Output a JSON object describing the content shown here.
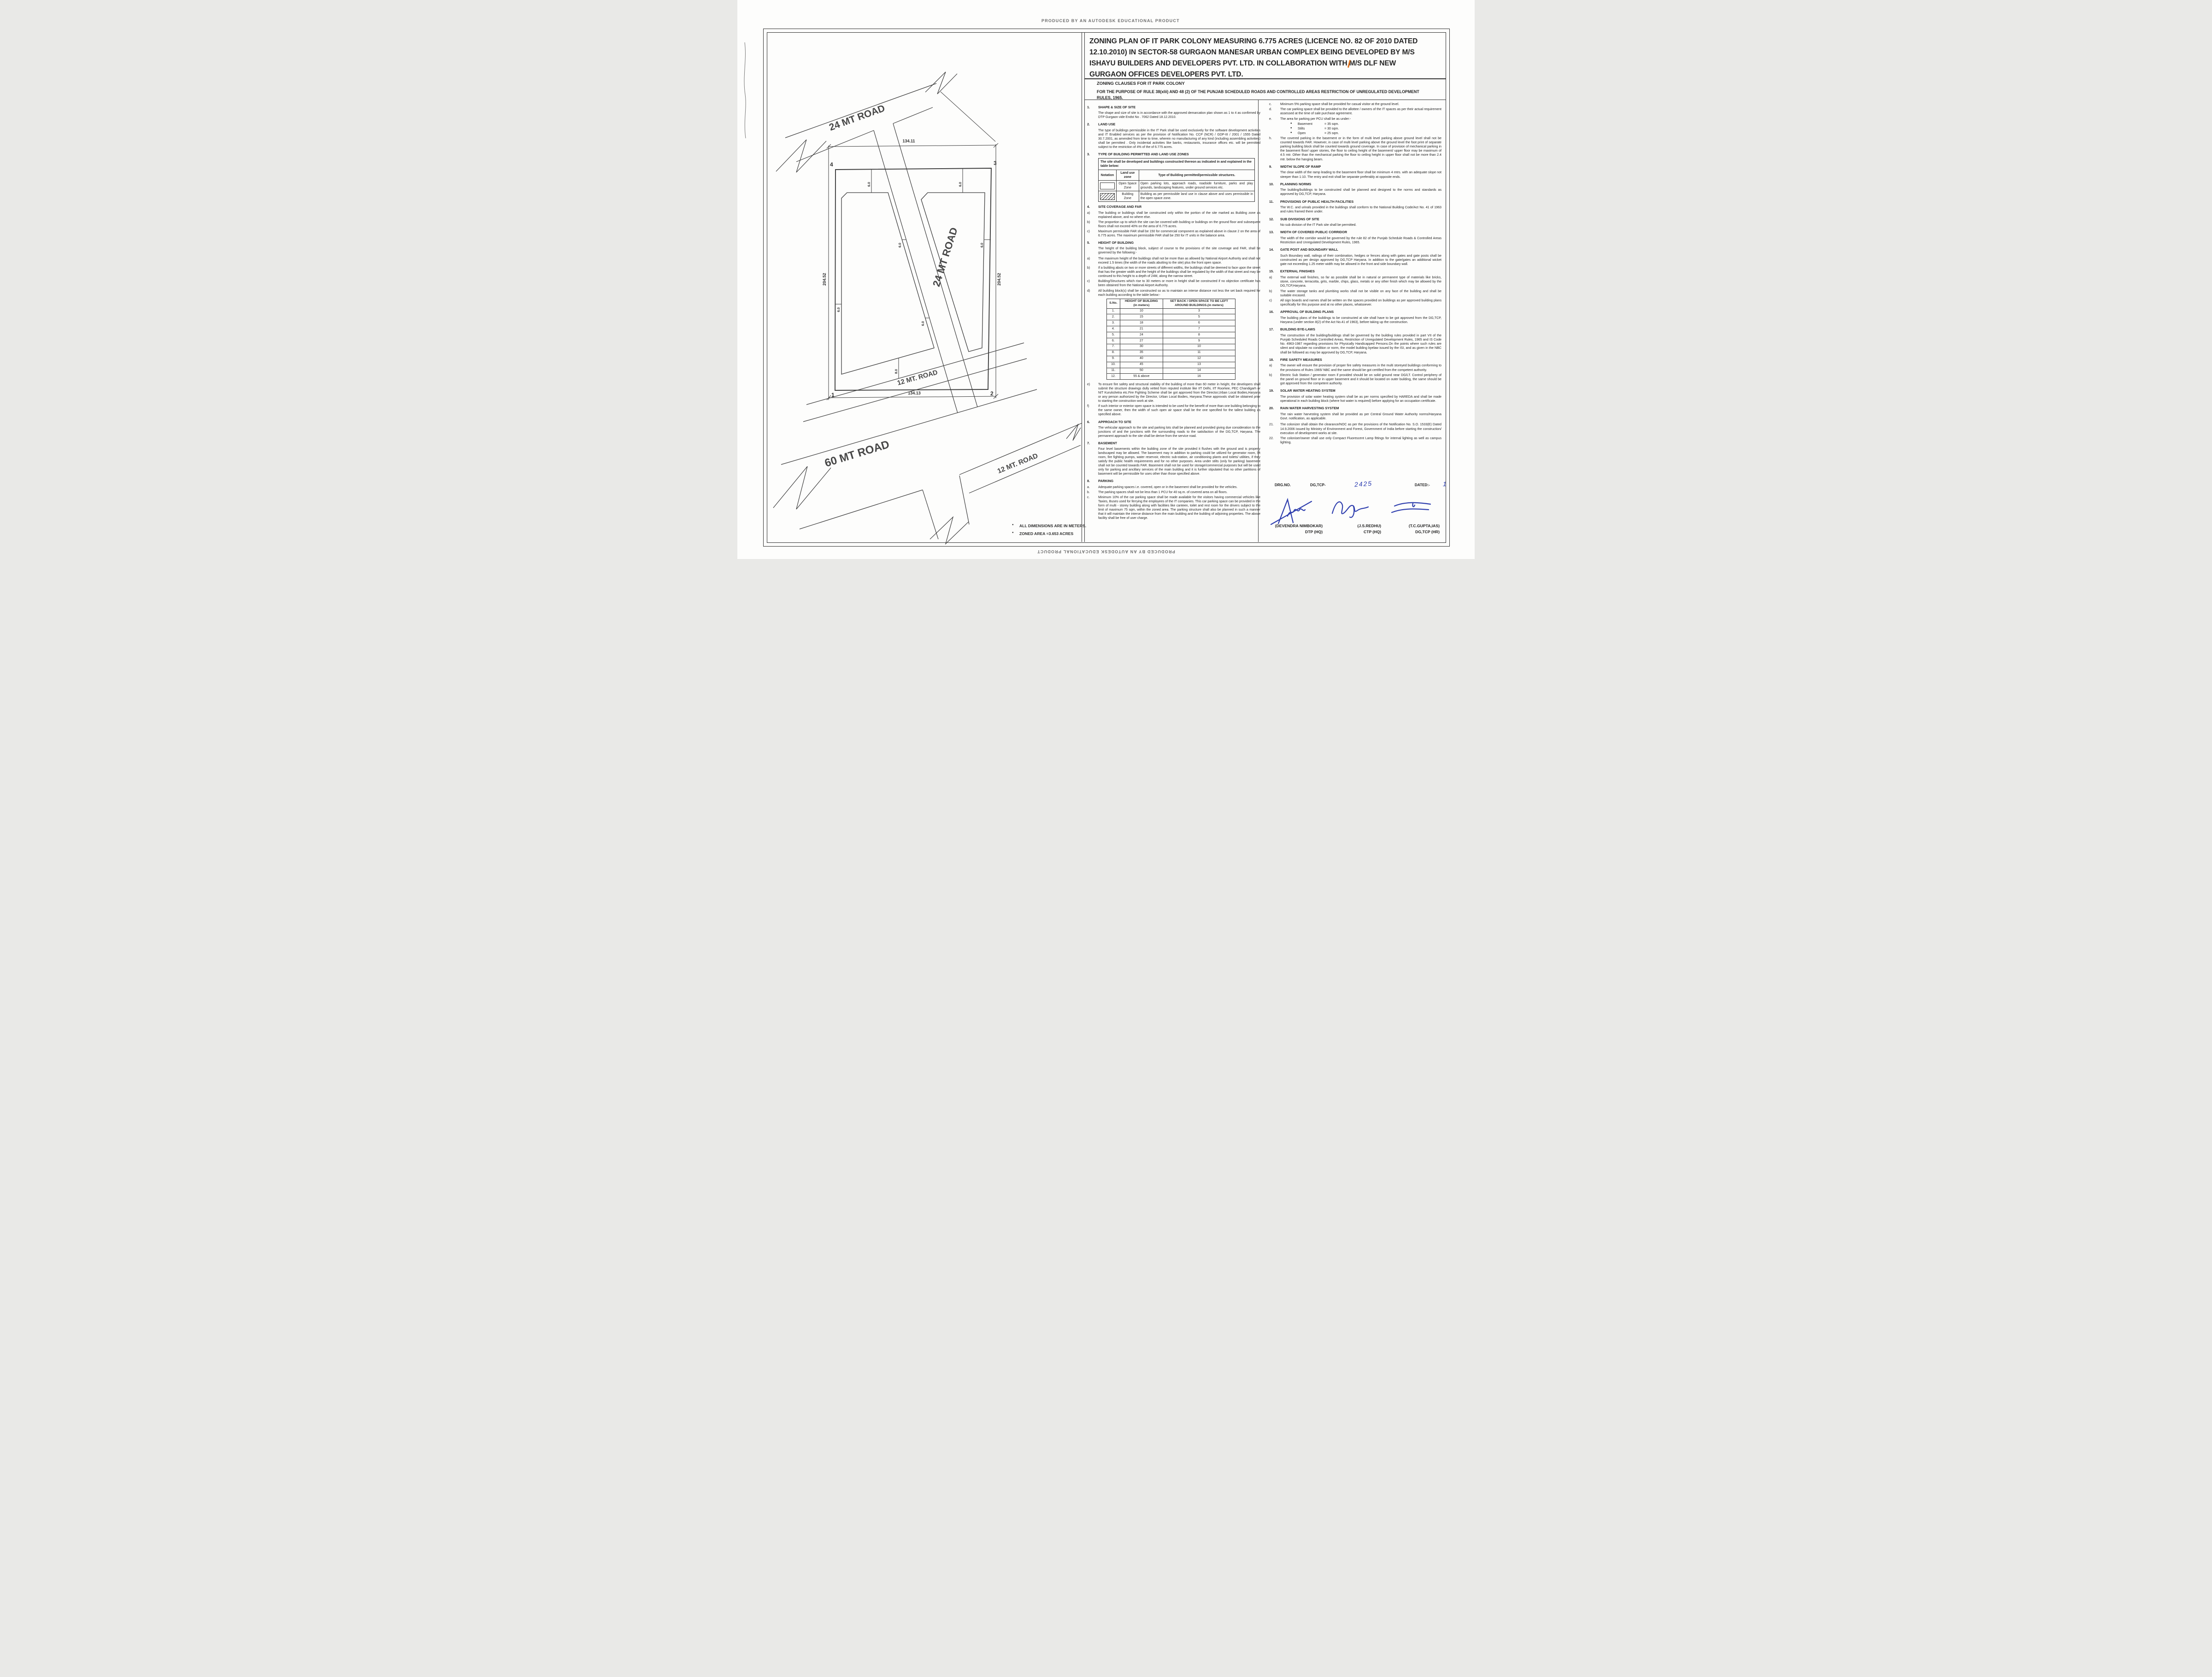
{
  "banner": {
    "top": "PRODUCED BY AN AUTODESK EDUCATIONAL PRODUCT",
    "bottom": "PRODUCED BY AN AUTODESK EDUCATIONAL PRODUCT"
  },
  "title": {
    "lines": [
      "ZONING PLAN OF IT PARK COLONY  MEASURING 6.775 ACRES (LICENCE NO. 82 OF 2010 DATED",
      "12.10.2010)  IN SECTOR-58 GURGAON MANESAR URBAN COMPLEX BEING DEVELOPED BY M/S",
      "ISHAYU BUILDERS AND DEVELOPERS PVT. LTD. IN COLLABORATION WITH M/S DLF NEW",
      "GURGAON OFFICES DEVELOPERS PVT. LTD."
    ],
    "sub1": "ZONING CLAUSES FOR IT PARK COLONY",
    "sub2": "FOR THE PURPOSE OF RULE 38(xlii) AND 48 (2) OF THE PUNJAB SCHEDULED ROADS AND  CONTROLLED AREAS RESTRICTION OF UNREGULATED DEVELOPMENT RULES, 1965."
  },
  "drawing": {
    "roads": {
      "top_road": "24 MT ROAD",
      "center_road": "24 MT ROAD",
      "inner_road": "12 MT. ROAD",
      "outer_road": "12 MT. ROAD",
      "main_road": "60 MT ROAD"
    },
    "dims": {
      "top": "134.11",
      "bottom": "134.13",
      "left": "204.52",
      "right": "204.52",
      "setback": "6.0",
      "setback_b": "8.0"
    },
    "corners": {
      "c1": "1",
      "c2": "2",
      "c3": "3",
      "c4": "4"
    },
    "notes": [
      "ALL DIMENSIONS ARE IN METERS.",
      "ZONED AREA =3.653 ACRES"
    ]
  },
  "land_use_table": {
    "caption": "The site shall be developed and buildings constructed thereon as indicated in and explained  in the table below:",
    "headers": [
      "Notation",
      "Land use zone",
      "Type of Building permitted/permissible structures."
    ],
    "rows": [
      {
        "notation": "open",
        "zone": "Open Space Zone",
        "desc": "Open parking lots, approach roads, roadside furniture, parks and play grounds, landscaping features, under ground services etc."
      },
      {
        "notation": "hatched",
        "zone": "Building Zone",
        "desc": "Building as per permissible land use in clause above and uses permissible in the open space zone."
      }
    ]
  },
  "height_table": {
    "headers": [
      "S.No.",
      "HEIGHT OF BUILDING\n(in meters)",
      "SET BACK / OPEN SPACE TO BE LEFT\nAROUND BUILDINGS.(in meters)"
    ],
    "rows": [
      [
        "1.",
        "10",
        "3"
      ],
      [
        "2.",
        "15",
        "5"
      ],
      [
        "3.",
        "18",
        "6"
      ],
      [
        "4.",
        "21",
        "7"
      ],
      [
        "5.",
        "24",
        "8"
      ],
      [
        "6.",
        "27",
        "9"
      ],
      [
        "7.",
        "30",
        "10"
      ],
      [
        "8.",
        "35",
        "11"
      ],
      [
        "9.",
        "40",
        "12"
      ],
      [
        "10.",
        "45",
        "13"
      ],
      [
        "11.",
        "50",
        "14"
      ],
      [
        "12.",
        "55 & above",
        "16"
      ]
    ]
  },
  "left_column": [
    {
      "t": "head",
      "n": "1.",
      "s": "SHAPE & SIZE OF SITE"
    },
    {
      "t": "para",
      "x": "The shape and size of site is in accordance with the approved demarcation plan shown as 1 to 4 as confirmed by DTP Gurgaon vide  Endst No . 7062 Dated 18.12.2010."
    },
    {
      "t": "head",
      "n": "2.",
      "s": "LAND USE"
    },
    {
      "t": "para",
      "x": "The type of buildings permissible in the IT Park shall be used exclusively for the software development activities and IT Enabled services as per the provision of Notification No. CCP (NCR) / GDP-III / 2001 / 1555 Dated 30.7.2001, as amended from time to time, wherein no manufacturing of any kind (including assembling activities) shall be permitted . Only incidental activities like banks, restaurants, insurance offices etc. will be permitted subject to the restriction of 4% of the of 6.775 acres."
    },
    {
      "t": "head",
      "n": "3.",
      "s": "TYPE OF BUILDING PERMITTED AND LAND USE ZONES"
    },
    {
      "t": "landuse"
    },
    {
      "t": "head",
      "n": "4.",
      "s": "SITE COVERAGE AND FAR"
    },
    {
      "t": "sub",
      "n": "a)",
      "x": "The building or buildings shall be constructed only within the portion of the site marked as Building zone  as explained above, and no where else."
    },
    {
      "t": "sub",
      "n": "b)",
      "x": "The proportion up to which the site can be covered with building or buildings on the ground floor and subsequent floors shall not exceed 40% on the area of 6.775 acres."
    },
    {
      "t": "sub",
      "n": "c)",
      "x": "Maximum permissible FAR shall be 150 for commercial component as explained above in  clause 2 on the area of 6.775 acres. The maximum permissible FAR shall be 250 for IT units in the balance area."
    },
    {
      "t": "head",
      "n": "5.",
      "s": "HEIGHT OF BUILDING"
    },
    {
      "t": "para",
      "x": "The height of the building block, subject of course to the provisions of the site coverage and FAR, shall be governed by the following:-"
    },
    {
      "t": "sub",
      "n": "a)",
      "x": "The maximum height of the buildings shall not be more than as allowed by National Airport Authority and shall not  exceed 1.5 times (the width of the roads abutting to the site) plus  the front open space."
    },
    {
      "t": "sub",
      "n": "b)",
      "x": "If a building abuts on two or more streets of different widths, the buildings shall be deemed to face upon the street that has the greater width and the height of the buildings shall be regulated by the width of that street and may be continued to this height to a depth of 24M, along the narrow street."
    },
    {
      "t": "sub",
      "n": "c)",
      "x": "Building/Structures which rise to 30 meters or more in height shall be constructed if no objection certificate has been obtained from the National Airport Authority."
    },
    {
      "t": "sub",
      "n": "d)",
      "x": "All building block(s) shall be constructed so as to maintain an interse distance not less the set back required for each building according to the table below:-"
    },
    {
      "t": "heights"
    },
    {
      "t": "sub",
      "n": "e)",
      "x": "To ensure fire safety and structural stability of the building of more than 60 meter in height, the developers shall submit the structure drawings dully vetted from reputed institute like IIT Delhi, IIT Roorkee, PEC Chandigarh or NIT Kurukshetra etc.Fire Fighting Scheme shall be got approved from the Director,Urban Local Bodies,Haryana or any person authorized by the Director, Urban Local Bodies, Haryana.These approvals shall be obtained prior to starting the construction work at site."
    },
    {
      "t": "sub",
      "n": "f)",
      "x": "If such interior or exterior open space is intended to be used for the benefit of more than one building belonging to the same owner, then the width of such open air space  shall be the one specified for the tallest building as specified above."
    },
    {
      "t": "head",
      "n": "6.",
      "s": "APPROACH TO SITE"
    },
    {
      "t": "para",
      "x": "The vehicular approach to the site and parking lots shall be planned and provided giving due consideration to the junctions of and the junctions with the surrounding roads to the satisfaction of the DG,TCP, Haryana. The permanent approach to the site shall be derive from the service road."
    },
    {
      "t": "head",
      "n": "7.",
      "s": "BASEMENT"
    },
    {
      "t": "para",
      "x": "Four level basements within the building zone of the site provided it flushes with the  ground and is properly landscaped may be allowed. The basement may in addition to  parking could be utilized for generator room, lift room, fire fighting pumps, water  reservoir, electric sub-station, air conditioning plants and toilets/ utilities, if they satisfy the  public health requirements and for no other purposes. Area under stilts (only for parking) basement shall not be counted towards FAR. Basement shall not be used for  storage/commercial purposes but will be used only for parking and ancillary services of the main building and  it is further stipulated that no other partitions of basement will be permissible for uses other than those specified above."
    },
    {
      "t": "head",
      "n": "8.",
      "s": "PARKING"
    },
    {
      "t": "sub",
      "n": "a.",
      "x": "Adequate parking spaces i.e. covered, open or in the basement shall be provided for the vehicles."
    },
    {
      "t": "sub",
      "n": "b.",
      "x": "The parking spaces shall not be less than 1 PCU for 40 sq.m. of covered area on all floors."
    },
    {
      "t": "sub",
      "n": "c.",
      "x": "Minimum 10% of the car parking space shall be made available for the visitors having commercial vehicles like Taxies, Buses used for ferrying the employees of the IT companies. This car parking space can be provided in the form of multi - storey building along with  facilities like canteen, toilet and rest room for the drivers subject to the limit of maximum 75 sqm, within the zoned area. The parking structure shall also be planned in such a manner that it will maintain the interse distance from the main building and the building of adjoining properties. The above facility shall be free of user charge."
    }
  ],
  "right_column": [
    {
      "t": "sub",
      "n": "c.",
      "x": "Minimum 5% parking space shall be provided for casual visitor at the ground level."
    },
    {
      "t": "sub",
      "n": "d.",
      "x": "The car parking space shall be provided to the allottee / owners of the IT spaces as per their actual requirement assessed at the time of sale purchase agreement."
    },
    {
      "t": "sub",
      "n": "e.",
      "x": "The area for parking per PCU shall be as under:-"
    },
    {
      "t": "bullet",
      "k": "Basement",
      "x": "= 35 sqm."
    },
    {
      "t": "bullet",
      "k": "Stilts",
      "x": "= 30 sqm."
    },
    {
      "t": "bullet",
      "k": "Open",
      "x": "= 25 sqm."
    },
    {
      "t": "sub",
      "n": "h.",
      "x": "The covered parking in the basement or in the form of multi level parking above ground level shall not be counted towards FAR. However, in case of multi level parking above the ground level the foot print of separate parking building block shall be counted towards ground coverage. In case of provision of mechanical parking in the basement floor/ upper stories, the floor to ceiling height of the basement/ upper floor may be maximum of 4.5 mtr. Other than the mechanical parking the floor to ceiling height in upper floor shall not be more than 2.4 mtr. below the hanging beam."
    },
    {
      "t": "head",
      "n": "9.",
      "s": "WIDTH/ SLOPE OF RAMP"
    },
    {
      "t": "para",
      "x": "The clear width of the ramp leading to the basement floor shall be minimum 4 mtrs. with an adequate slope not steeper than 1:10. The entry and exit shall be separate preferably at opposite ends."
    },
    {
      "t": "head",
      "n": "10.",
      "s": "PLANNING NORMS"
    },
    {
      "t": "para",
      "x": "The building/buildings to be constructed shall be planned and designed to the norms and standards as approved by DG,TCP, Haryana."
    },
    {
      "t": "head",
      "n": "11.",
      "s": "PROVISIONS OF PUBLIC HEALTH FACILITIES"
    },
    {
      "t": "para",
      "x": "The W.C. and urinals provided in the buildings shall conform to the National Building Code/Act No. 41  of 1963 and rules framed there under."
    },
    {
      "t": "head",
      "n": "12.",
      "s": "SUB DIVISIONS OF SITE"
    },
    {
      "t": "para",
      "x": "No sub division of the IT Park site shall be permitted."
    },
    {
      "t": "head",
      "n": "13.",
      "s": "WIDTH OF COVERED PUBLIC CORRIDOR"
    },
    {
      "t": "para",
      "x": "The width of the corridor would be governed by the rule 82 of the Punjab Schedule Roads & Controlled Areas Restriction and Unregulated Development Rules, 1965."
    },
    {
      "t": "head",
      "n": "14.",
      "s": "GATE POST AND BOUNDARY WALL"
    },
    {
      "t": "para",
      "x": "Such Boundary wall, railings of their combination, hedges or fences along with gates and gate posts shall be constructed as per design approved by DG,TCP Haryana. In addition to the gate/gates an additional wicket gate not exceeding 1.25 meter width may be allowed in the front and side  boundary wall."
    },
    {
      "t": "head",
      "n": "15.",
      "s": "EXTERNAL FINISHES"
    },
    {
      "t": "sub",
      "n": "a)",
      "x": "The external wall finishes, so far as possible shall be in natural or permanent type of materials like bricks, stone, concrete, terracotta, grits, marble, chips, glass, metals or any other finish which may   be allowed by the DG,TCP,Haryana."
    },
    {
      "t": "sub",
      "n": "b)",
      "x": "The water storage tanks and plumbing works shall not be visible on any face of the building and  shall be suitable encased."
    },
    {
      "t": "sub",
      "n": "c)",
      "x": "All sign boards and names shall be written on the spaces provided on buildings as per approved building plans specifically for this purpose and at no other places, whatsoever."
    },
    {
      "t": "head",
      "n": "16.",
      "s": "APPROVAL OF BUILDING PLANS"
    },
    {
      "t": "para",
      "x": "The building plans of the buildings to be constructed at site shall have to be got approved from the DG,TCP, Haryana (under section 8(2) of the Act No.41 of 1963), before taking up the construction."
    },
    {
      "t": "head",
      "n": "17.",
      "s": "BUILDING BYE-LAWS"
    },
    {
      "t": "para",
      "x": "The construction of the building/buildings shall be governed by the building rules provided in part  VII of the Punjab Scheduled Roads Controlled Areas, Restriction of Unregulated Development Rules, 1965 and IS Code No. 4963-1987 regarding provisions for Physically Handicapped Persons.On  the points where such rules are silent   and stipulate no condition or norm, the model building byelaw issued by the ISI, and as given in the NBC shall be followed as may be approved by DG,TCP, Haryana."
    },
    {
      "t": "head",
      "n": "18.",
      "s": "FIRE SAFETY MEASURES"
    },
    {
      "t": "sub",
      "n": "a)",
      "x": "The owner will ensure the provision of proper fire safety measures in the multi storeyed buildings  conforming to the provisions of  Rules 1965/ NBC and the same should be got certified from the  competent authority."
    },
    {
      "t": "sub",
      "n": "b)",
      "x": "Electric Sub Station / generator room if provided should be on solid ground near DG/LT. Control   periphery of the panel on ground floor or in upper basement and it should be located on outer building, the same should be got approved from the competent authority."
    },
    {
      "t": "head",
      "n": "19.",
      "s": "SOLAR WATER HEATING SYSTEM"
    },
    {
      "t": "para",
      "x": "The provision of solar water heating system shall be as per norms specified by HAREDA  and shall be made operational in each building block (where hot water is required) before applying for an occupation certificate."
    },
    {
      "t": "head",
      "n": "20.",
      "s": "RAIN WATER HARVESTING SYSTEM"
    },
    {
      "t": "para",
      "x": "The rain water harvesting system shall be provided as per Central Ground Water Authority norms/Haryana Govt. notification, as applicable."
    },
    {
      "t": "sub",
      "n": "21.",
      "x": "The colonizer shall obtain the clearance/NOC as per the provisions of the Notification  No. S.O. 1533(E) Dated 14.9.2006 issued by Ministry of Environment and Forest, Government of India before starting the construction/ execution of development  works at site."
    },
    {
      "t": "sub",
      "n": "22.",
      "x": "The coloniser/owner shall use only Compact Fluorescent Lamp fittings for internal lighting as well as campus lighting."
    }
  ],
  "drg": {
    "l1": "DRG.NO.",
    "l2": "DG,TCP-",
    "no": "2425",
    "l3": "DATED:-",
    "date": "18.03.2011"
  },
  "signatures": [
    {
      "name": "(DEVENDRA NIMBOKAR)",
      "title": "DTP (HQ)"
    },
    {
      "name": "(J.S.REDHU)",
      "title": "CTP (HQ)"
    },
    {
      "name": "(T.C.GUPTA,IAS)",
      "title": "DG,TCP (HR)"
    }
  ]
}
